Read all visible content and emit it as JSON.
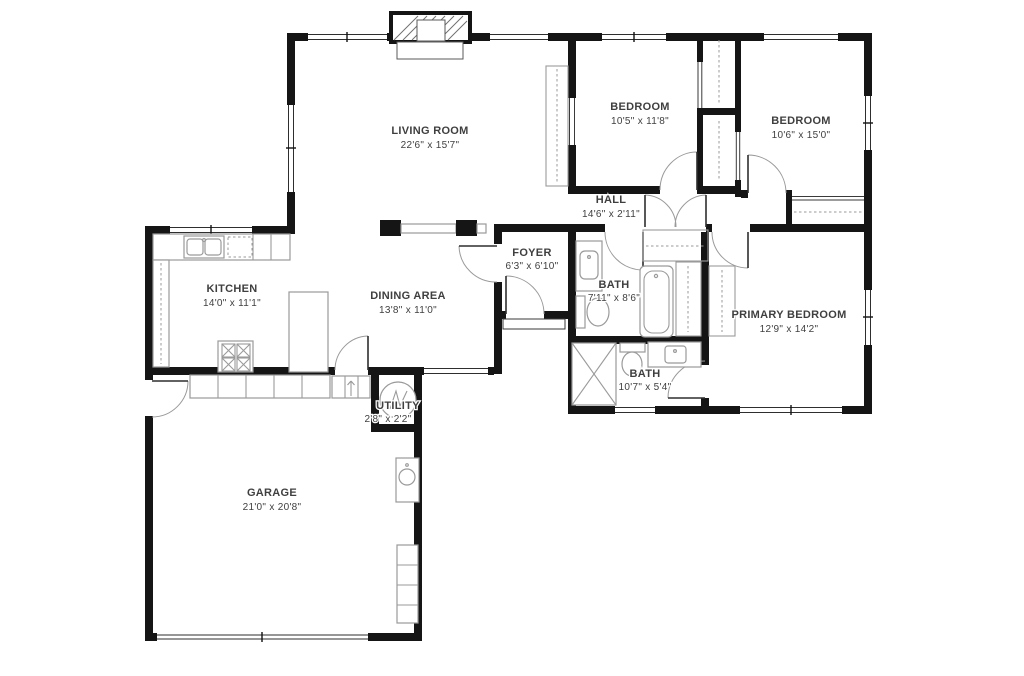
{
  "floor_plan": {
    "title": "single-story house floor plan",
    "rooms": {
      "living_room": {
        "name": "LIVING ROOM",
        "dims": "22'6\" x 15'7\""
      },
      "bedroom_1": {
        "name": "BEDROOM",
        "dims": "10'5\" x 11'8\""
      },
      "bedroom_2": {
        "name": "BEDROOM",
        "dims": "10'6\" x 15'0\""
      },
      "hall": {
        "name": "HALL",
        "dims": "14'6\" x 2'11\""
      },
      "foyer": {
        "name": "FOYER",
        "dims": "6'3\" x 6'10\""
      },
      "kitchen": {
        "name": "KITCHEN",
        "dims": "14'0\" x 11'1\""
      },
      "dining_area": {
        "name": "DINING AREA",
        "dims": "13'8\" x 11'0\""
      },
      "bath_hall": {
        "name": "BATH",
        "dims": "7'11\" x 8'6\""
      },
      "primary_bedroom": {
        "name": "PRIMARY BEDROOM",
        "dims": "12'9\" x 14'2\""
      },
      "bath_primary": {
        "name": "BATH",
        "dims": "10'7\" x 5'4\""
      },
      "garage": {
        "name": "GARAGE",
        "dims": "21'0\" x 20'8\""
      },
      "utility": {
        "name": "UTILITY",
        "dims": "2'8\" x 2'2\""
      }
    },
    "colors": {
      "wall": "#151515",
      "fixture": "#9a9a9a",
      "label": "#3f3f3f",
      "background": "#ffffff"
    }
  }
}
